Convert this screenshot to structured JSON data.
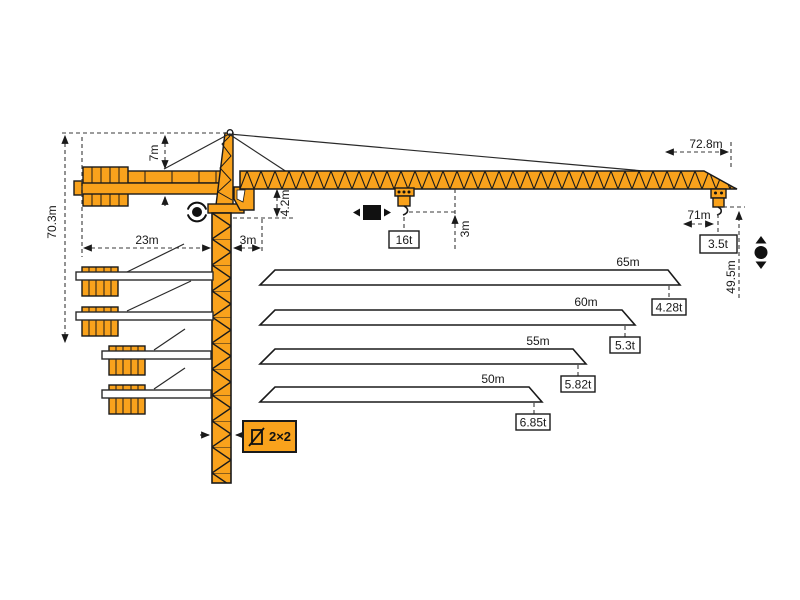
{
  "diagram": {
    "type": "tower-crane-specification-diagram",
    "colors": {
      "crane_orange": "#F9A21C",
      "outline": "#1A1A1A",
      "dimension_line": "#3A3A3A"
    },
    "dimensions": {
      "overall_height": "70.3m",
      "tower_head_height": "7m",
      "counter_jib_length": "23m",
      "slew_offset": "3m",
      "tower_top_height": "4.2m",
      "hook_offset": "3m",
      "max_capacity": "16t",
      "max_radius": "72.8m",
      "tip_hook_radius": "71m",
      "tip_capacity": "3.5t",
      "hook_height": "49.5m"
    },
    "mast_section": {
      "label": "2×2"
    },
    "jib_options": [
      {
        "length": "65m",
        "tip_capacity": "4.28t"
      },
      {
        "length": "60m",
        "tip_capacity": "5.3t"
      },
      {
        "length": "55m",
        "tip_capacity": "5.82t"
      },
      {
        "length": "50m",
        "tip_capacity": "6.85t"
      }
    ],
    "icons": [
      "slewing-icon",
      "trolley-travel-icon",
      "hoisting-icon",
      "mast-section-icon"
    ]
  }
}
